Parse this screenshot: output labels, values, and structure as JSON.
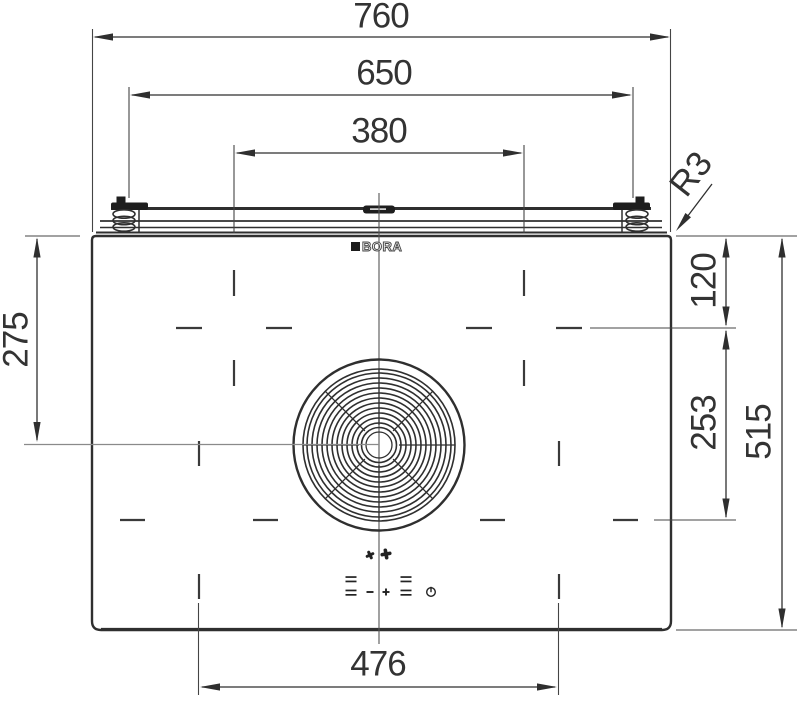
{
  "drawing": {
    "brand": "BORA",
    "dimension_labels": {
      "overall_width": "760",
      "mounting_clip_span": "650",
      "rear_zone_spacing": "380",
      "front_zone_spacing": "476",
      "fan_center_offset": "275",
      "rear_zone_offset": "120",
      "zone_row_spacing": "253",
      "overall_depth": "515",
      "corner_radius": "R3"
    },
    "icons": {
      "fan_small": "fan-icon",
      "fan_large": "fan-icon",
      "minus": "minus-icon",
      "plus": "plus-icon",
      "level_left": "level-bars-icon",
      "level_right": "level-bars-icon",
      "power": "power-icon"
    },
    "colors": {
      "line": "#2f2f2f",
      "text": "#333333",
      "aux_line": "#8a8a8a",
      "background": "#ffffff"
    }
  }
}
